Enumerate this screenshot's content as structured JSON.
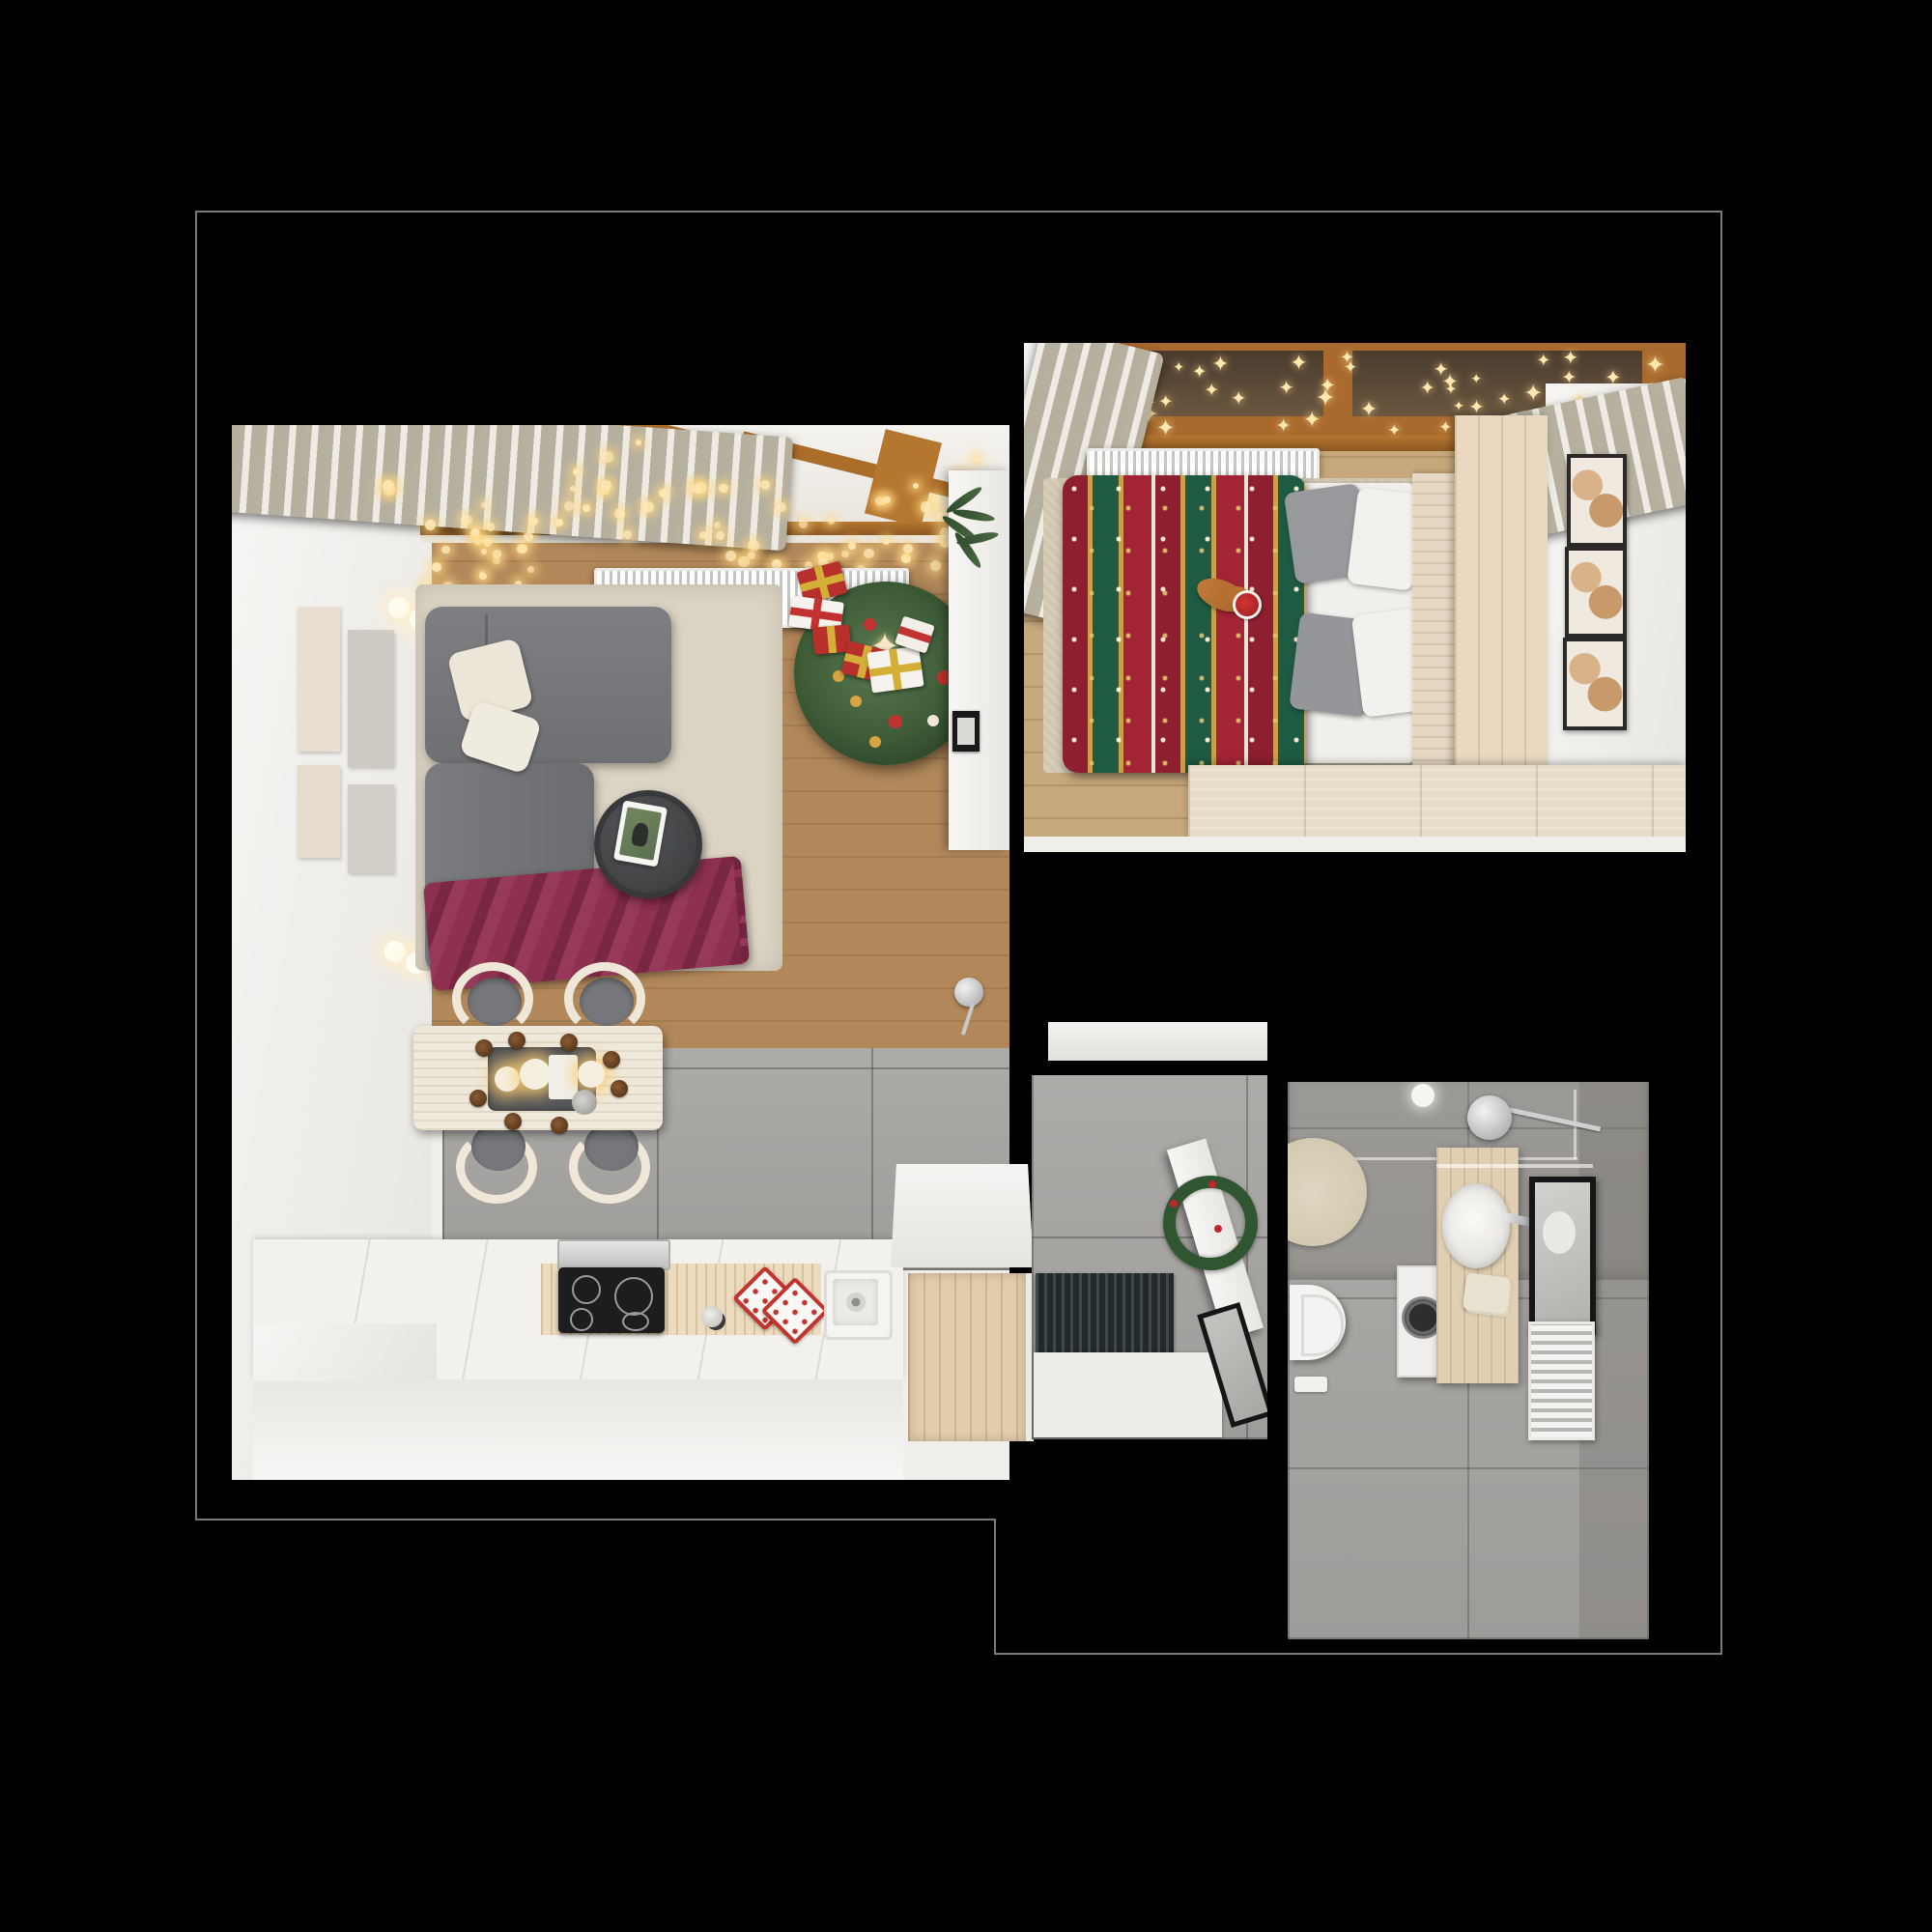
{
  "scene": {
    "type": "apartment-floor-plan-top-down-render",
    "style": "photorealistic 3d visualization, christmas decorated, black background",
    "rooms": [
      {
        "name": "living-room-with-kitchen",
        "items": [
          "gray-corner-sofa",
          "cream-pillows",
          "burgundy-throw-blanket",
          "round-coffee-table",
          "tablet",
          "beige-rug",
          "wall-art-panels",
          "wall-sconces",
          "string-lights",
          "beige-curtain",
          "wood-window-frame",
          "white-radiator",
          "christmas-tree",
          "gift-boxes",
          "white-sideboard",
          "palm-plant",
          "chrome-floor-lamp",
          "dining-table",
          "four-chairs",
          "candle-centerpiece",
          "pinecones",
          "white-kitchen-counter",
          "induction-cooktop",
          "extractor-hood",
          "kitchen-sink",
          "mug",
          "red-potholders",
          "herringbone-wood-floor",
          "gray-tile-floor"
        ]
      },
      {
        "name": "bedroom",
        "items": [
          "double-bed",
          "christmas-pattern-blanket",
          "white-sheets",
          "gray-pillows",
          "white-pillows",
          "cat-with-santa-hat",
          "beige-rug",
          "white-radiator",
          "star-string-lights",
          "beige-curtains",
          "wood-window-frame",
          "wood-headboard",
          "wardrobe",
          "art-triptych",
          "long-dresser",
          "chevron-wood-floor"
        ]
      },
      {
        "name": "hallway",
        "items": [
          "open-white-door",
          "christmas-wreath",
          "leaning-mirror",
          "dark-slatted-doormat",
          "white-entry-mat",
          "white-cabinet",
          "refrigerator",
          "wood-closet",
          "gray-tile-floor"
        ]
      },
      {
        "name": "bathroom",
        "items": [
          "shower-head",
          "glass-screen",
          "ceiling-light",
          "round-beige-rug",
          "wall-hung-toilet",
          "washing-machine",
          "wood-vanity",
          "oval-basin",
          "chrome-faucet",
          "towels",
          "black-framed-mirror",
          "glass-shelf",
          "towel-radiator",
          "floor-scale",
          "gray-stone-tiles"
        ]
      }
    ]
  },
  "colors": {
    "background": "#000000",
    "outline": "#7a7a7a",
    "wall_white": "#f4f3f0",
    "wood_living": "#b2885a",
    "wood_bedroom": "#c7a87c",
    "tile_gray": "#a8a6a3",
    "sofa_gray": "#75777a",
    "pillow_cream": "#ece6d8",
    "throw_burgundy": "#8e3050",
    "rug_beige": "#dcd4c3",
    "tree_green": "#3c5a36",
    "ornament_red": "#c23230",
    "ornament_gold": "#d9a441",
    "gift_red": "#b8302c",
    "gift_white": "#f6f3ee",
    "ribbon_gold": "#d4af37",
    "blanket_red": "#9e2433",
    "blanket_green": "#1f5a43",
    "blanket_gold": "#c9a04e",
    "bed_white": "#f1efeb",
    "pillow_gray": "#97999c",
    "curtain_beige": "#d8d2c2",
    "window_wood": "#b5762f",
    "light_warm": "#ffe7b0",
    "radiator_white": "#f7f6f3",
    "counter_white": "#f2f1ee",
    "cooktop_black": "#1d1d1f",
    "hood_silver": "#d7d7d5",
    "potholder_red": "#c2342e",
    "vanity_wood": "#e0cfb2",
    "mat_dark": "#23282a",
    "wreath_green": "#2f5531",
    "berry_red": "#c0262c",
    "cat_orange": "#c07a3a",
    "santa_red": "#c0262c"
  }
}
